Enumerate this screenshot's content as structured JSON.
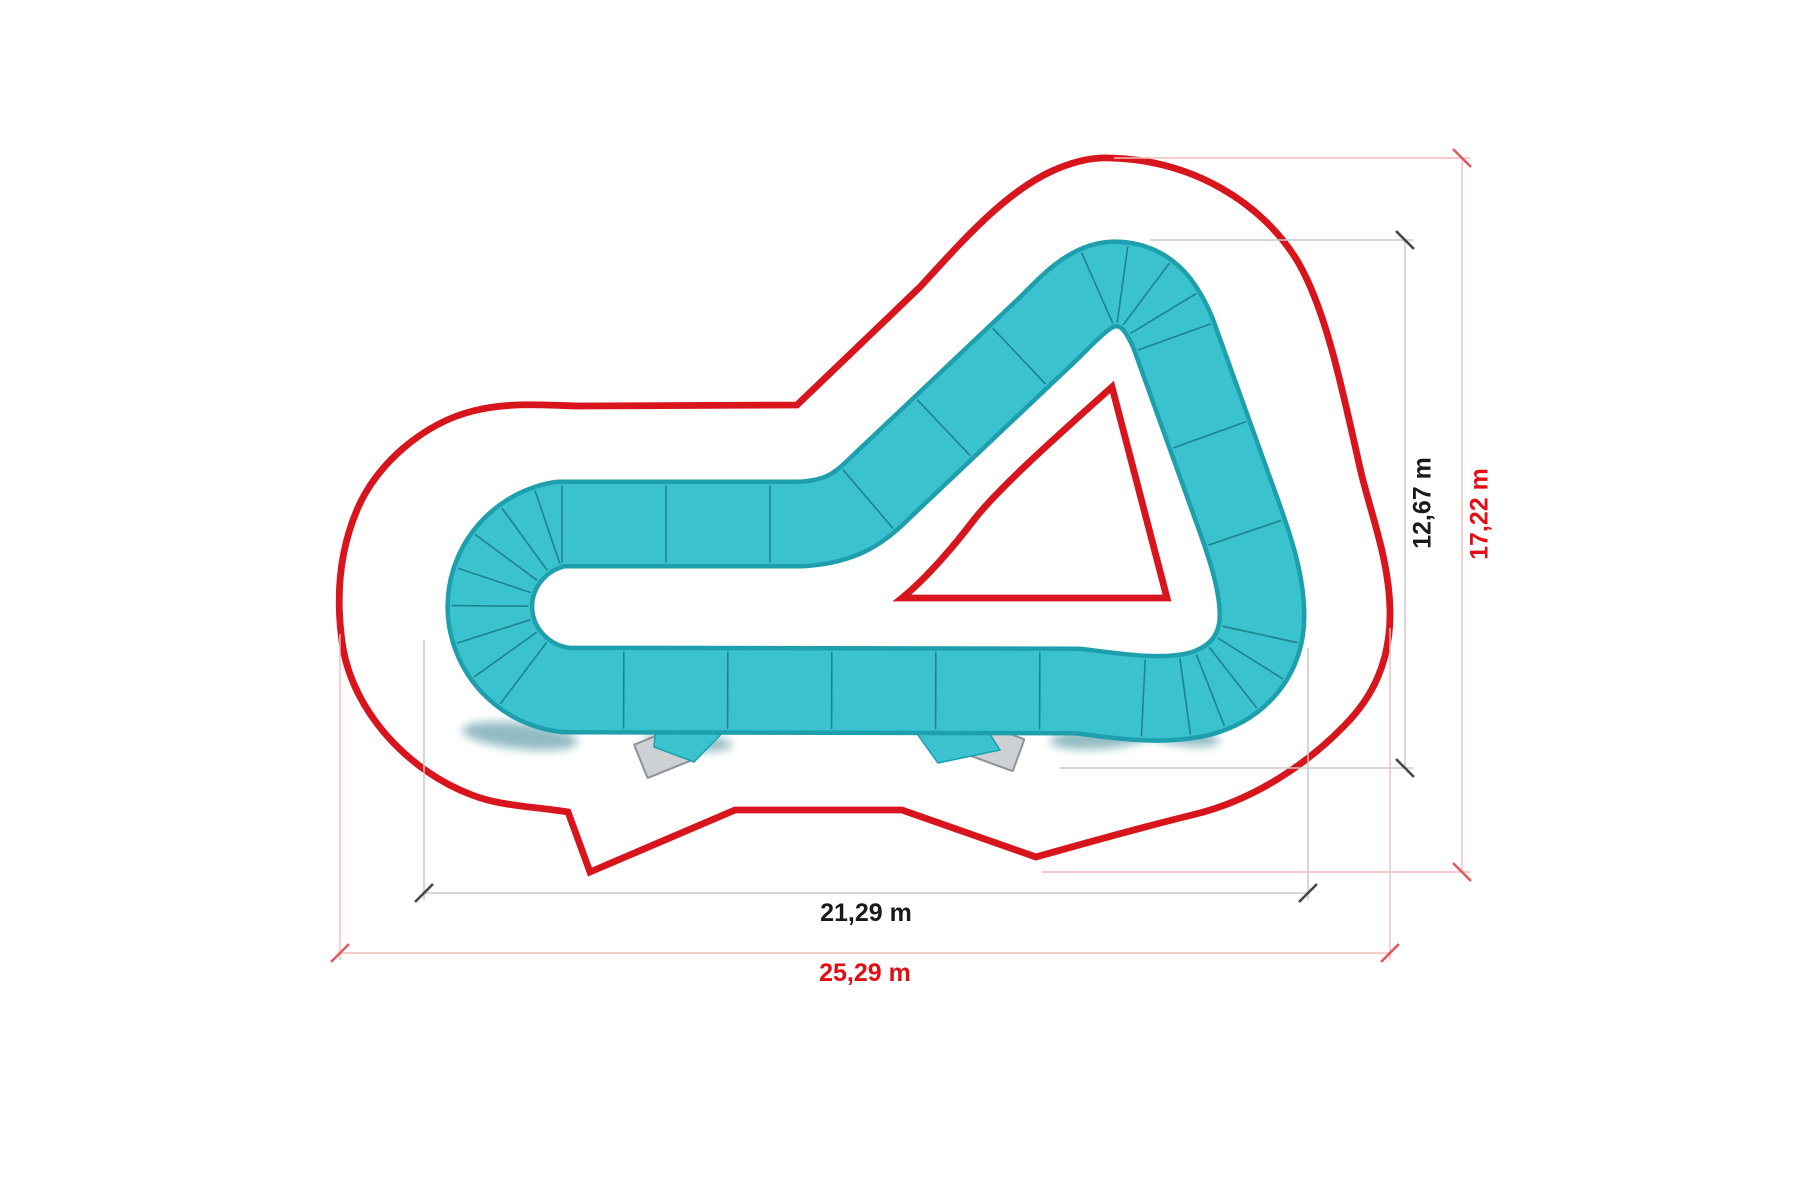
{
  "diagram": {
    "kind": "pump-track-plan",
    "dimensions": {
      "track_height_label": "12,67 m",
      "site_height_label": "17,22 m",
      "track_width_label": "21,29 m",
      "site_width_label": "25,29 m"
    },
    "colors": {
      "track_fill": "#3ac3ce",
      "track_edge": "#1e9fae",
      "track_line": "#156d7a",
      "track_shadow": "#0e6b78",
      "outline_red": "#d8141c",
      "dim_gray": "#c8c8c8",
      "dim_gray_tick": "#474747",
      "dim_red": "#f2bcbc",
      "dim_red_tick": "#dd5a5e",
      "label_black": "#1a1a1a",
      "label_red": "#e30d13",
      "pad_fill": "#cdd1d4",
      "pad_edge": "#8d9398"
    }
  }
}
